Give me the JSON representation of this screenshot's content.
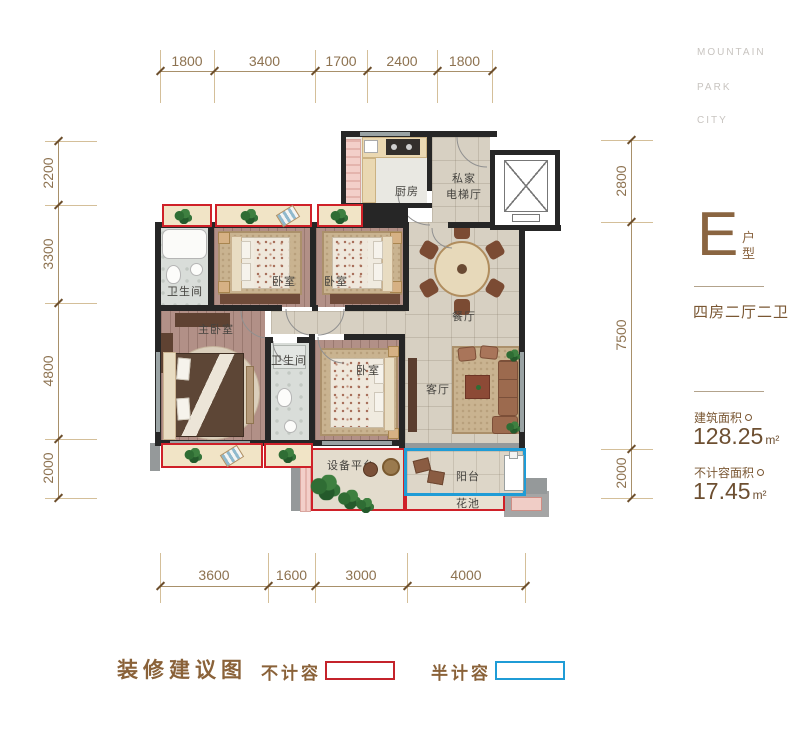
{
  "brand": {
    "lines": [
      "MOUNTAIN",
      "PARK",
      "CITY"
    ]
  },
  "unit": {
    "letter": "E",
    "type_label": "户型",
    "rooms_desc": "四房二厅二卫",
    "area1_label": "建筑面积",
    "area1_value": "128.25",
    "area1_unit": "m²",
    "area2_label": "不计容面积",
    "area2_value": "17.45",
    "area2_unit": "m²"
  },
  "legend": {
    "title": "装修建议图",
    "item1": {
      "label": "不计容",
      "color": "#cf2028"
    },
    "item2": {
      "label": "半计容",
      "color": "#1f9cd6"
    }
  },
  "dims": {
    "top": [
      "1800",
      "3400",
      "1700",
      "2400",
      "1800"
    ],
    "left": [
      "2200",
      "3300",
      "4800",
      "2000"
    ],
    "right": [
      "2800",
      "7500",
      "2000"
    ],
    "bottom": [
      "3600",
      "1600",
      "3000",
      "4000"
    ]
  },
  "rooms": {
    "bath1": "卫生间",
    "bed2": "卧室",
    "bed3": "卧室",
    "master": "主卧室",
    "bath2": "卫生间",
    "bed4": "卧室",
    "kitchen": "厨房",
    "hall1": "私家",
    "hall2": "电梯厅",
    "dining": "餐厅",
    "living": "客厅",
    "equipment": "设备平台",
    "balcony": "阳台",
    "flower": "花池"
  }
}
